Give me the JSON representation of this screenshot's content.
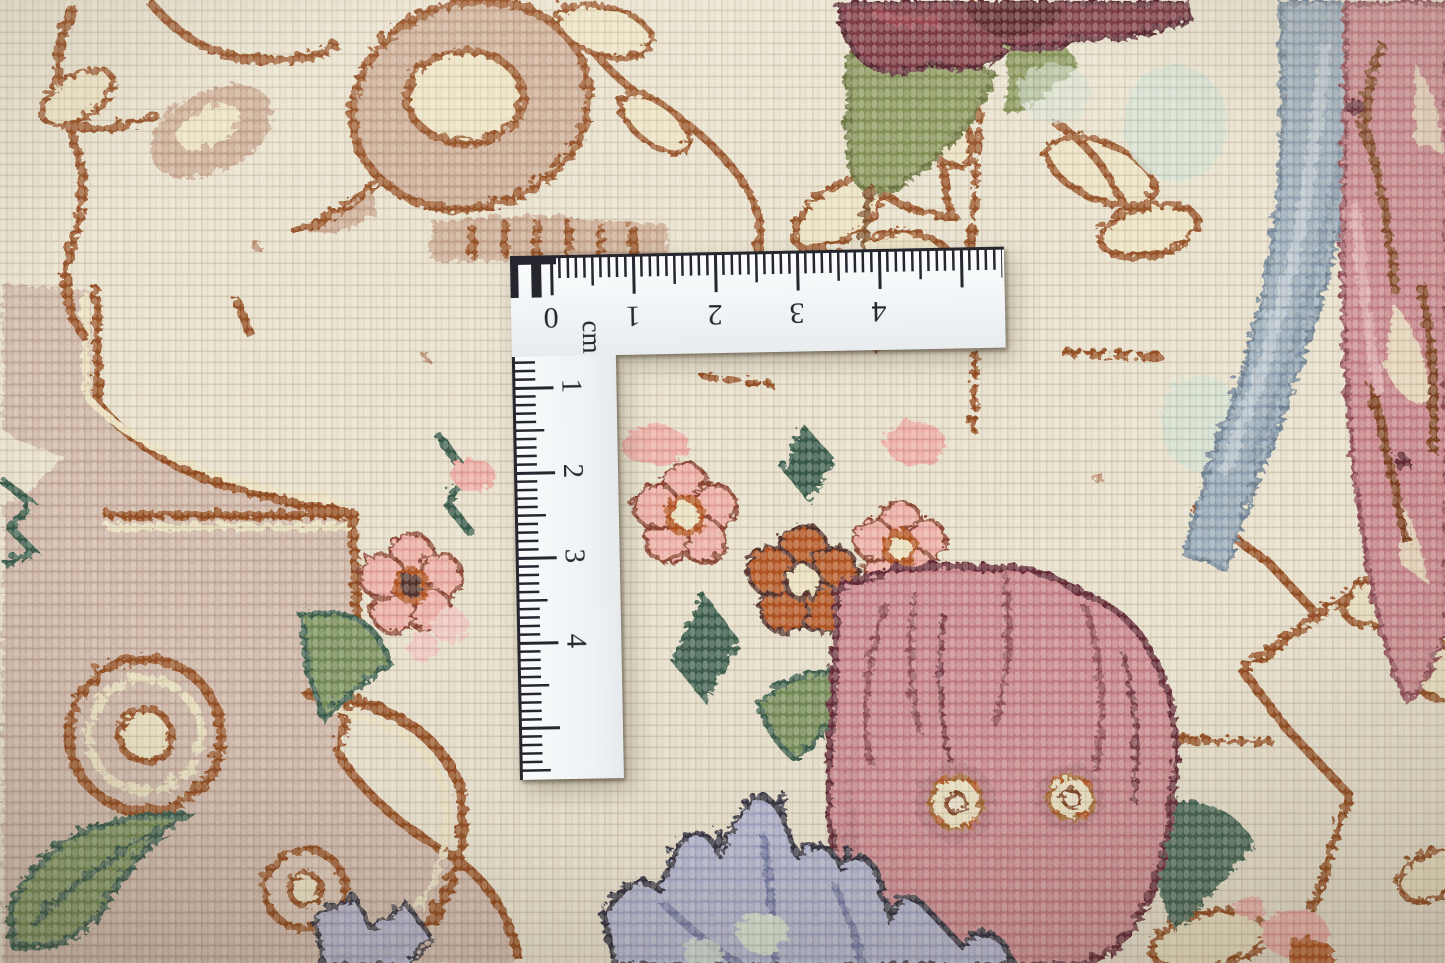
{
  "scene": {
    "description": "Close-up photograph of a cream hand-knotted oriental carpet with rust, pink, green and blue floral motifs, measured by a white L-shaped centimetre ruler"
  },
  "ruler": {
    "unit_label": "cm",
    "horizontal_scale": [
      "0",
      "1",
      "2",
      "3",
      "4"
    ],
    "vertical_scale": [
      "1",
      "2",
      "3",
      "4"
    ]
  },
  "palette": {
    "background_cream": "#e8e1ce",
    "field_taupe": "#cdb4a7",
    "paisley_tan": "#c8a68f",
    "accent_cream": "#ece2c2",
    "outline_rust": "#93491f",
    "leaf_dark_green": "#335948",
    "leaf_medium_green": "#6f8a55",
    "leaf_olive": "#7c8c4d",
    "flower_salmon": "#eeaaa4",
    "flower_rust_orange": "#b34f1e",
    "flower_dusty_rose": "#c87f8a",
    "flower_maroon": "#5f2130",
    "flower_burgundy": "#6e2433",
    "flower_lavender": "#a9aed0",
    "flower_navy_outline": "#2b2a3d",
    "leaf_steel_blue": "#93a7ba",
    "mint_green": "#cfdfd2",
    "ruler_white": "#f6f8f9",
    "ruler_markings": "#26262f"
  }
}
